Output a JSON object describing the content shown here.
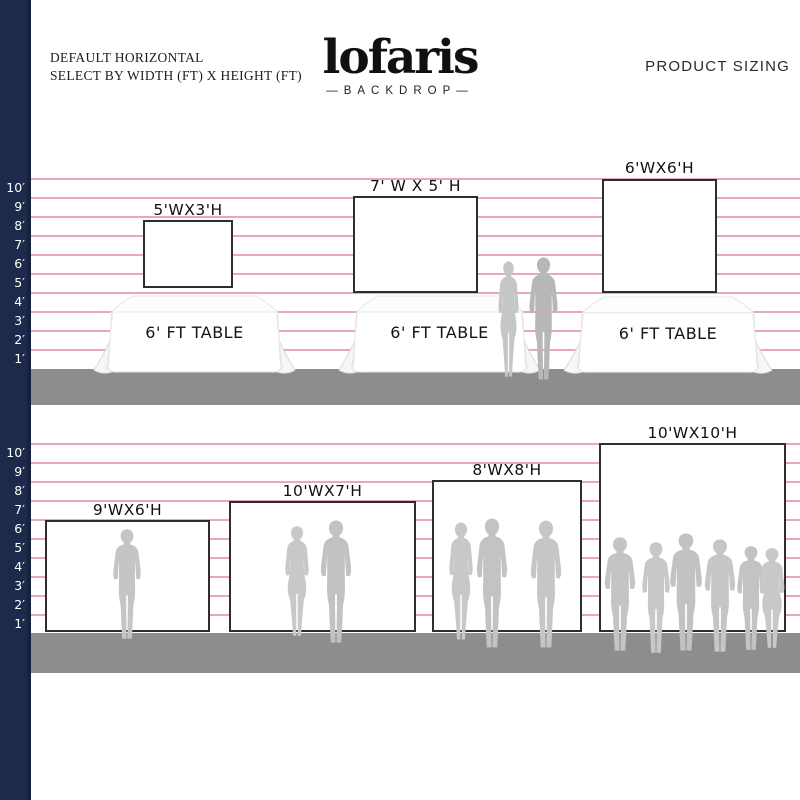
{
  "header": {
    "subtitle_line1": "DEFAULT HORIZONTAL",
    "subtitle_line2": "SELECT BY WIDTH (FT) X HEIGHT (FT)",
    "brand": "lofaris",
    "brand_sub": "—BACKDROP—",
    "right_title": "PRODUCT SIZING"
  },
  "ruler": {
    "ticks": [
      "10′",
      "9′",
      "8′",
      "7′",
      "6′",
      "5′",
      "4′",
      "3′",
      "2′",
      "1′"
    ]
  },
  "sections": {
    "top": {
      "table_label": "6' FT TABLE",
      "backdrops": [
        {
          "label": "5'WX3'H",
          "width_ft": 5,
          "height_ft": 3
        },
        {
          "label": "7' W X 5' H",
          "width_ft": 7,
          "height_ft": 5
        },
        {
          "label": "6'WX6'H",
          "width_ft": 6,
          "height_ft": 6
        }
      ]
    },
    "bottom": {
      "backdrops": [
        {
          "label": "9'WX6'H",
          "width_ft": 9,
          "height_ft": 6
        },
        {
          "label": "10'WX7'H",
          "width_ft": 10,
          "height_ft": 7
        },
        {
          "label": "8'WX8'H",
          "width_ft": 8,
          "height_ft": 8
        },
        {
          "label": "10'WX10'H",
          "width_ft": 10,
          "height_ft": 10
        }
      ]
    }
  },
  "colors": {
    "navy": "#1e2a4c",
    "grid_line": "#eaa7b4",
    "floor": "#8d8d8d",
    "silhouette": "#c3c3c3",
    "backdrop_border": "#2e2e2e"
  }
}
